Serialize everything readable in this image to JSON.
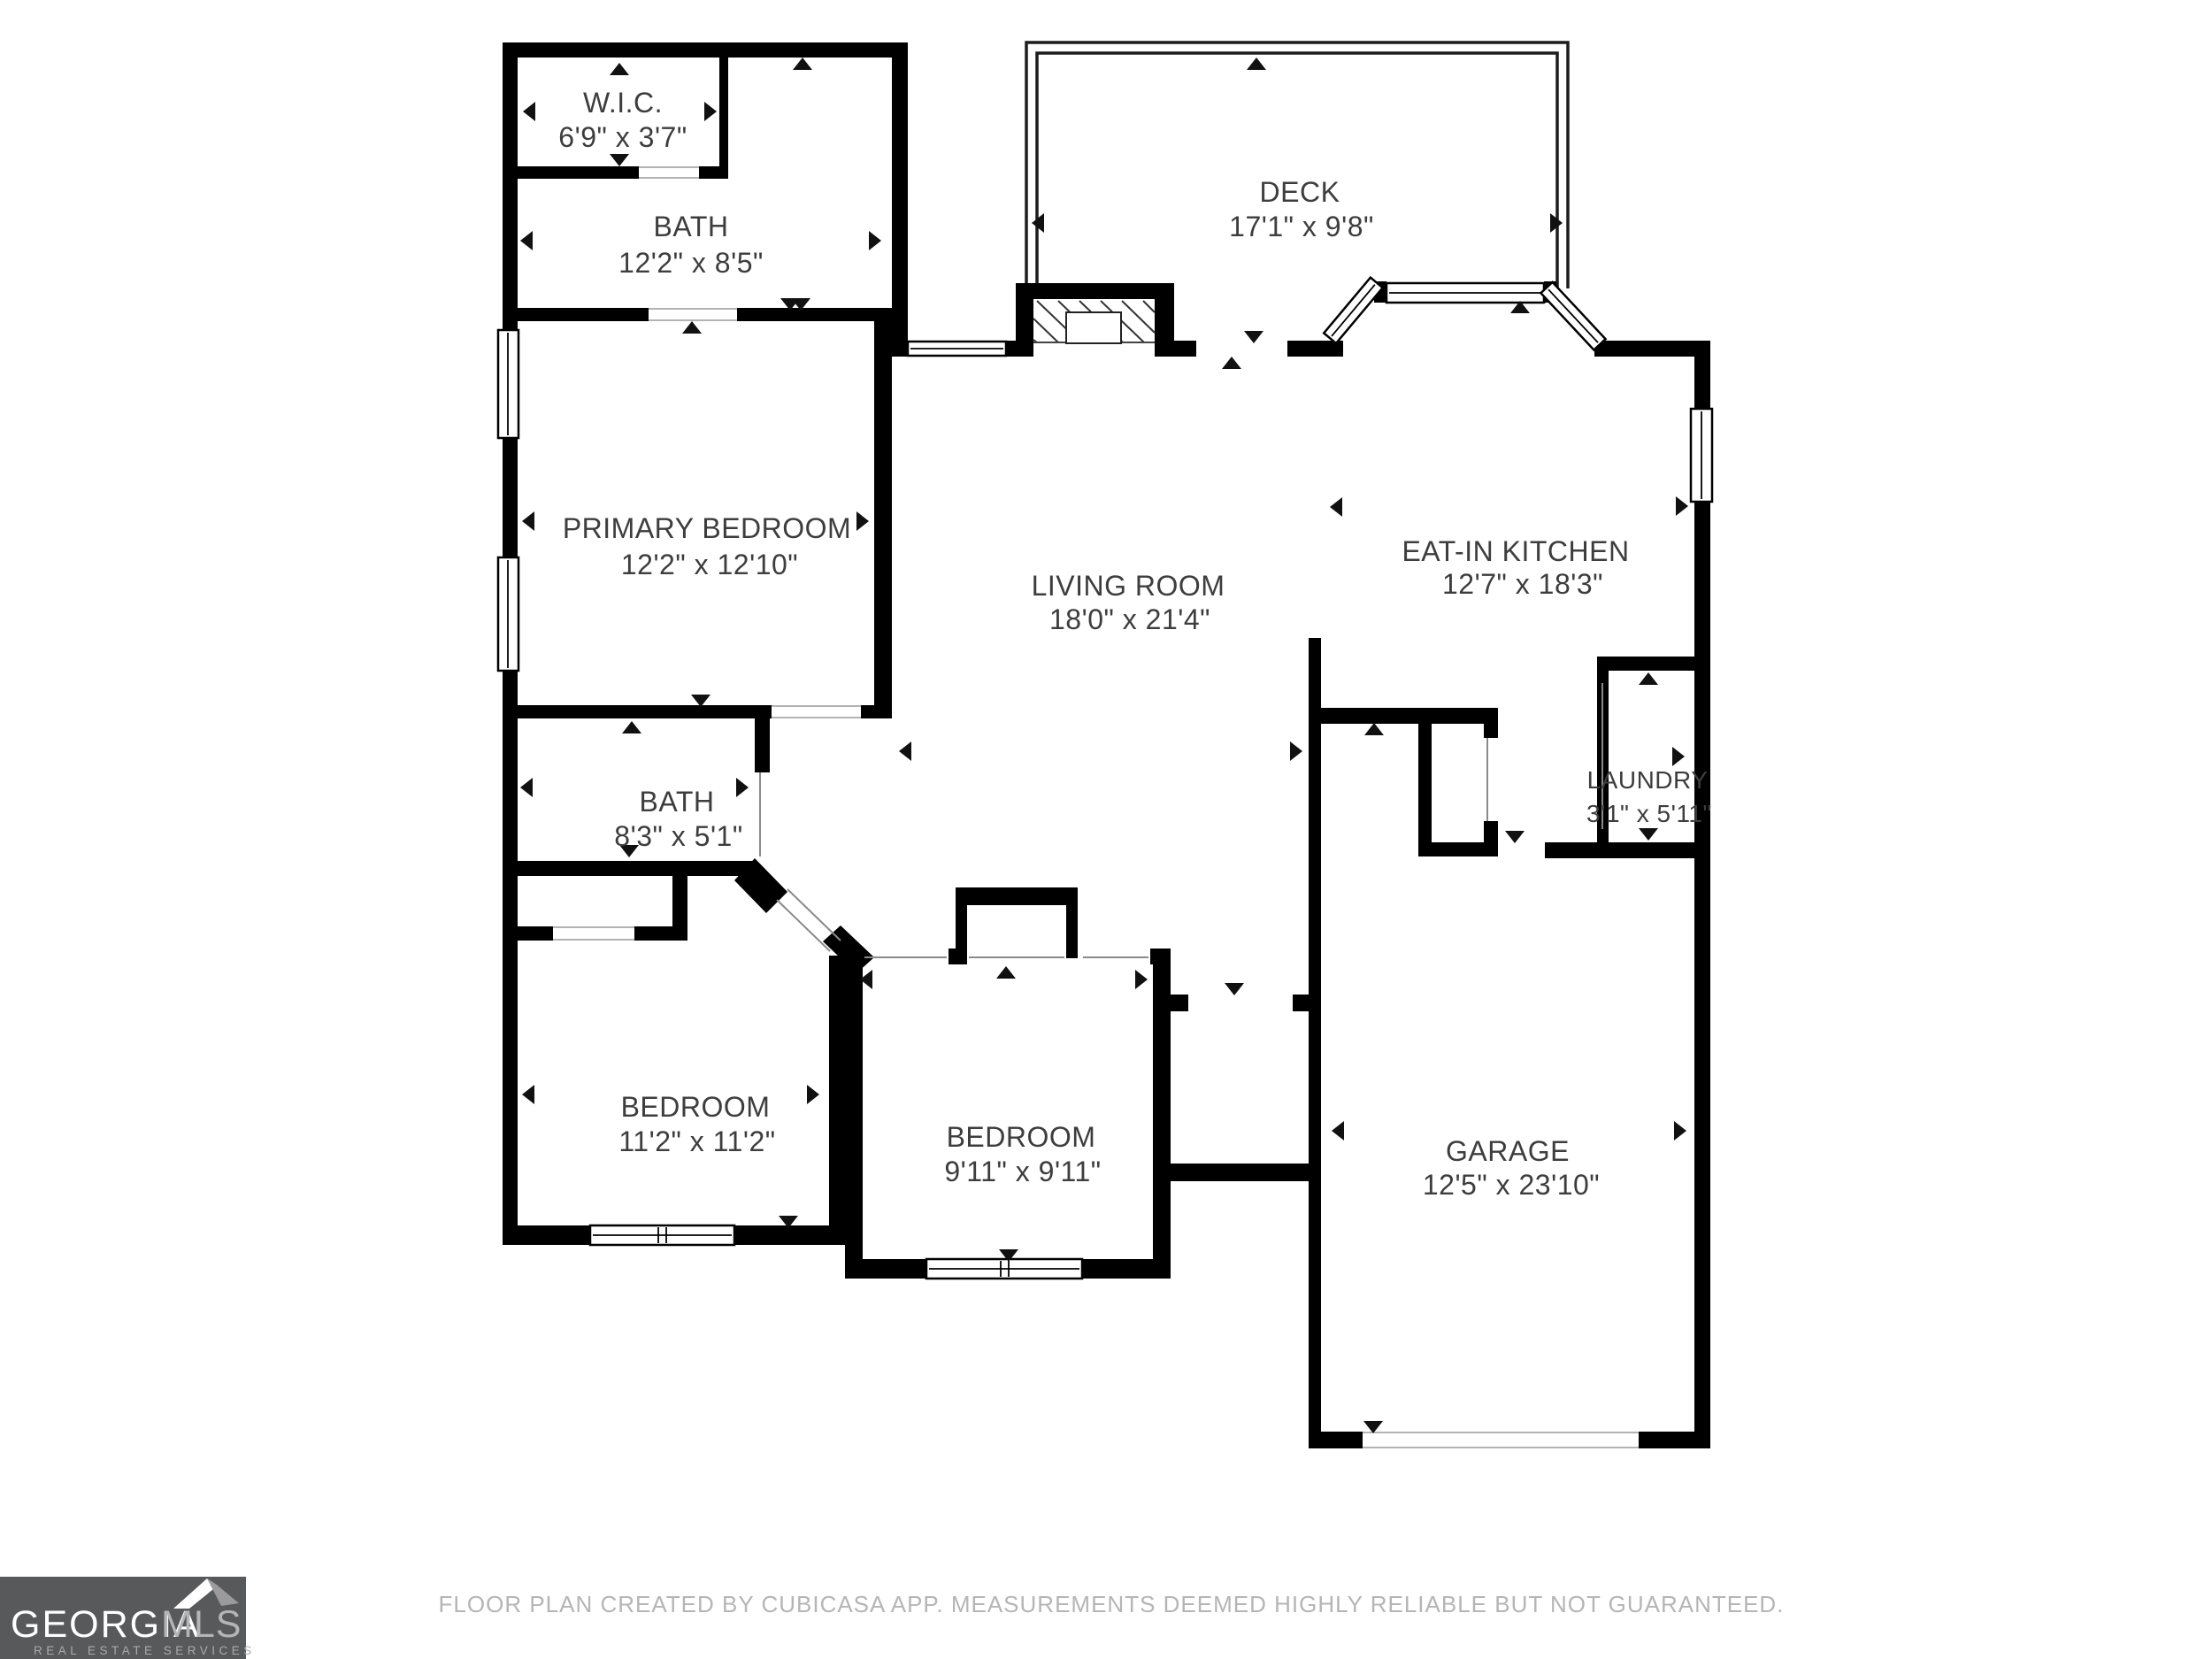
{
  "plan": {
    "wall_color": "#000000",
    "label_color": "#3d3d3d",
    "rooms": [
      {
        "name": "W.I.C.",
        "dims": "6'9\" x 3'7\""
      },
      {
        "name": "BATH",
        "dims": "12'2\" x 8'5\""
      },
      {
        "name": "DECK",
        "dims": "17'1\" x 9'8\""
      },
      {
        "name": "PRIMARY BEDROOM",
        "dims": "12'2\" x 12'10\""
      },
      {
        "name": "LIVING ROOM",
        "dims": "18'0\" x 21'4\""
      },
      {
        "name": "EAT-IN KITCHEN",
        "dims": "12'7\" x 18'3\""
      },
      {
        "name": "LAUNDRY",
        "dims": "3'1\" x 5'11\""
      },
      {
        "name": "BATH",
        "dims": "8'3\" x 5'1\""
      },
      {
        "name": "BEDROOM",
        "dims": "11'2\" x 11'2\""
      },
      {
        "name": "BEDROOM",
        "dims": "9'11\" x 9'11\""
      },
      {
        "name": "GARAGE",
        "dims": "12'5\" x 23'10\""
      }
    ]
  },
  "footer": {
    "disclaimer": "FLOOR PLAN CREATED BY CUBICASA APP. MEASUREMENTS DEEMED HIGHLY RELIABLE BUT NOT GUARANTEED."
  },
  "logo": {
    "brand": "GEORGIA",
    "brand_suffix": "MLS",
    "tagline": "REAL ESTATE SERVICES",
    "bg_color": "#58595b"
  }
}
